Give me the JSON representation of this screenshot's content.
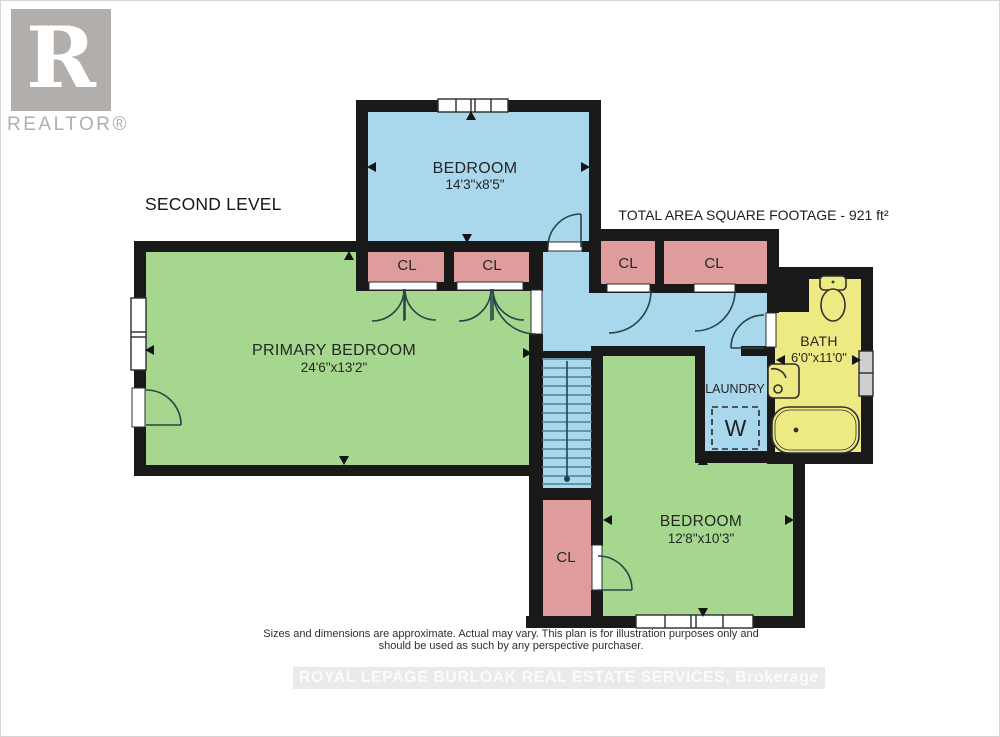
{
  "branding": {
    "logo_letter": "R",
    "logo_word": "REALTOR®"
  },
  "header": {
    "level_label": "SECOND LEVEL",
    "total_area_label": "TOTAL AREA SQUARE FOOTAGE - 921 ft²"
  },
  "rooms": {
    "bedroom_top": {
      "name": "BEDROOM",
      "dims": "14'3\"x8'5\""
    },
    "primary": {
      "name": "PRIMARY BEDROOM",
      "dims": "24'6\"x13'2\""
    },
    "bath": {
      "name": "BATH",
      "dims": "6'0\"x11'0\""
    },
    "laundry": {
      "name": "LAUNDRY",
      "washer_label": "W"
    },
    "bedroom_bottom": {
      "name": "BEDROOM",
      "dims": "12'8\"x10'3\""
    },
    "closet_label": "CL"
  },
  "footer": {
    "disclaimer_line1": "Sizes and dimensions are approximate. Actual may vary. This plan is for illustration purposes only and",
    "disclaimer_line2": "should be used as such by any perspective purchaser.",
    "watermark": "ROYAL LEPAGE BURLOAK REAL ESTATE SERVICES, Brokerage"
  },
  "colors": {
    "wall": "#191919",
    "room_blue": "#a9d7ec",
    "room_green": "#a5d78e",
    "closet_pink": "#df9c9c",
    "bath_yellow": "#edea83",
    "logo_gray": "#b2aeab"
  }
}
